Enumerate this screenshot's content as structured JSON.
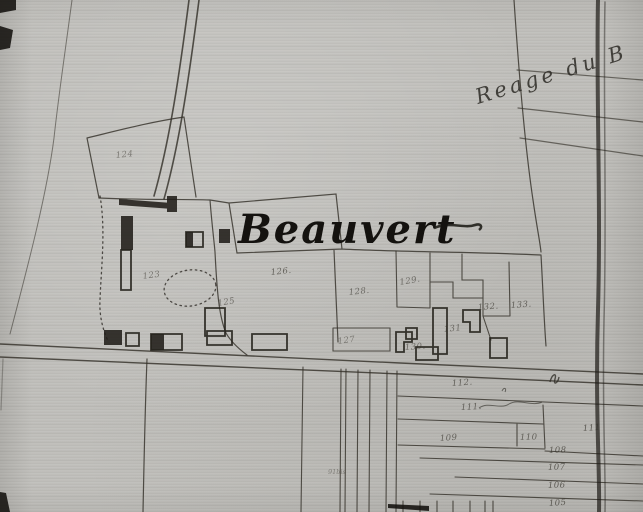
{
  "map": {
    "place_label": "Beauvert",
    "road_label": "Reage du B",
    "strip_note": "91bis"
  },
  "parcels": [
    {
      "label": "124"
    },
    {
      "label": "123"
    },
    {
      "label": "125"
    },
    {
      "label": "126."
    },
    {
      "label": "128."
    },
    {
      "label": "129."
    },
    {
      "label": "132."
    },
    {
      "label": "133."
    },
    {
      "label": "131"
    },
    {
      "label": "130."
    },
    {
      "label": "127"
    },
    {
      "label": "112."
    },
    {
      "label": "111."
    },
    {
      "label": "111"
    },
    {
      "label": "110"
    },
    {
      "label": "109"
    },
    {
      "label": "108"
    },
    {
      "label": "107"
    },
    {
      "label": "106"
    },
    {
      "label": "105"
    }
  ],
  "colors": {
    "ink": "#2b2823",
    "paper": "#c2c1bd"
  }
}
